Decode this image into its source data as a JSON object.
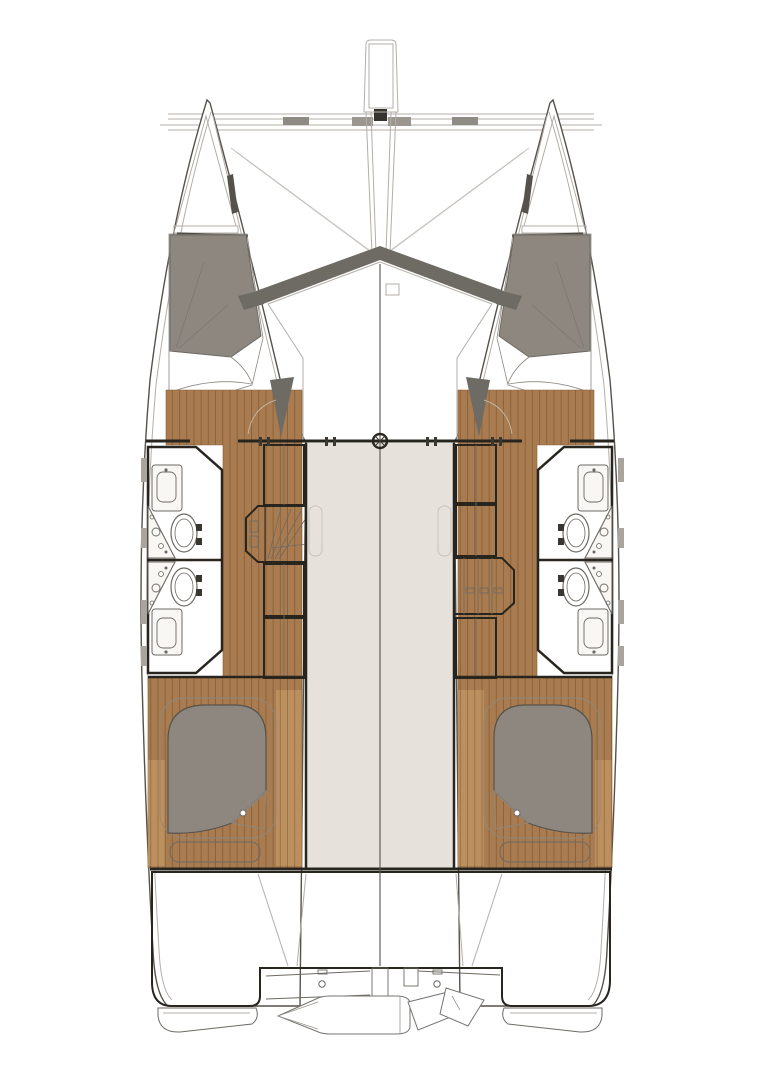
{
  "colors": {
    "background": "#ffffff",
    "hull_fill": "#ffffff",
    "outline": "#55514b",
    "wall": "#28251f",
    "line_light": "#b3aea7",
    "deck": "#dedad2",
    "deck_light": "#e6e2db",
    "deck_dim": "#d6d1c9",
    "trim_dark": "#6e6a64",
    "wood": "#a87c50",
    "wood_dark": "#8a6137",
    "wood_light": "#bc8f5e",
    "duvet": "#8d8780",
    "sheet": "#fbfaf8",
    "bath_floor": "#edebe6",
    "fixture": "#f8f7f4",
    "locker": "#e9e6e0",
    "locker_stripe": "#9b968f",
    "window": "#a9a49e",
    "mast": "#36332e"
  },
  "diagram": {
    "type": "catamaran-interior-deck-plan",
    "view": "overhead",
    "symmetry": "bilateral",
    "hulls": [
      "port",
      "starboard"
    ],
    "rooms": [
      {
        "name": "forward-cabin-port",
        "furniture": [
          "double-berth",
          "duvet",
          "folded-sheet"
        ]
      },
      {
        "name": "forward-cabin-starboard",
        "furniture": [
          "double-berth",
          "duvet",
          "folded-sheet"
        ]
      },
      {
        "name": "bathroom-port-forward",
        "fixtures": [
          "vanity-shower",
          "toilet",
          "corner-sink"
        ]
      },
      {
        "name": "bathroom-port-aft",
        "fixtures": [
          "vanity-shower",
          "toilet",
          "corner-sink"
        ]
      },
      {
        "name": "bathroom-starboard-forward",
        "fixtures": [
          "vanity-shower",
          "toilet",
          "corner-sink"
        ]
      },
      {
        "name": "bathroom-starboard-aft",
        "fixtures": [
          "vanity-shower",
          "toilet",
          "corner-sink"
        ]
      },
      {
        "name": "aft-cabin-port",
        "furniture": [
          "double-berth",
          "bench-step"
        ]
      },
      {
        "name": "aft-cabin-starboard",
        "furniture": [
          "double-berth",
          "bench-step"
        ]
      },
      {
        "name": "saloon-bridgedeck",
        "furniture": []
      },
      {
        "name": "aft-cockpit",
        "furniture": []
      }
    ],
    "equipment": [
      "bowsprit-longeron",
      "forward-crossbeam",
      "anchor-fitting",
      "trampoline",
      "mast-step",
      "companionway-stairs-port",
      "companionway-stairs-starboard",
      "louvered-lockers",
      "hull-windows",
      "davit-lines",
      "stern-cleats",
      "transom-steps",
      "swim-platform-port",
      "swim-platform-starboard",
      "dinghy-tender",
      "outboard-engine"
    ],
    "counts": {
      "cabins": 4,
      "bathrooms": 4,
      "toilets": 4,
      "berths": 4
    }
  }
}
